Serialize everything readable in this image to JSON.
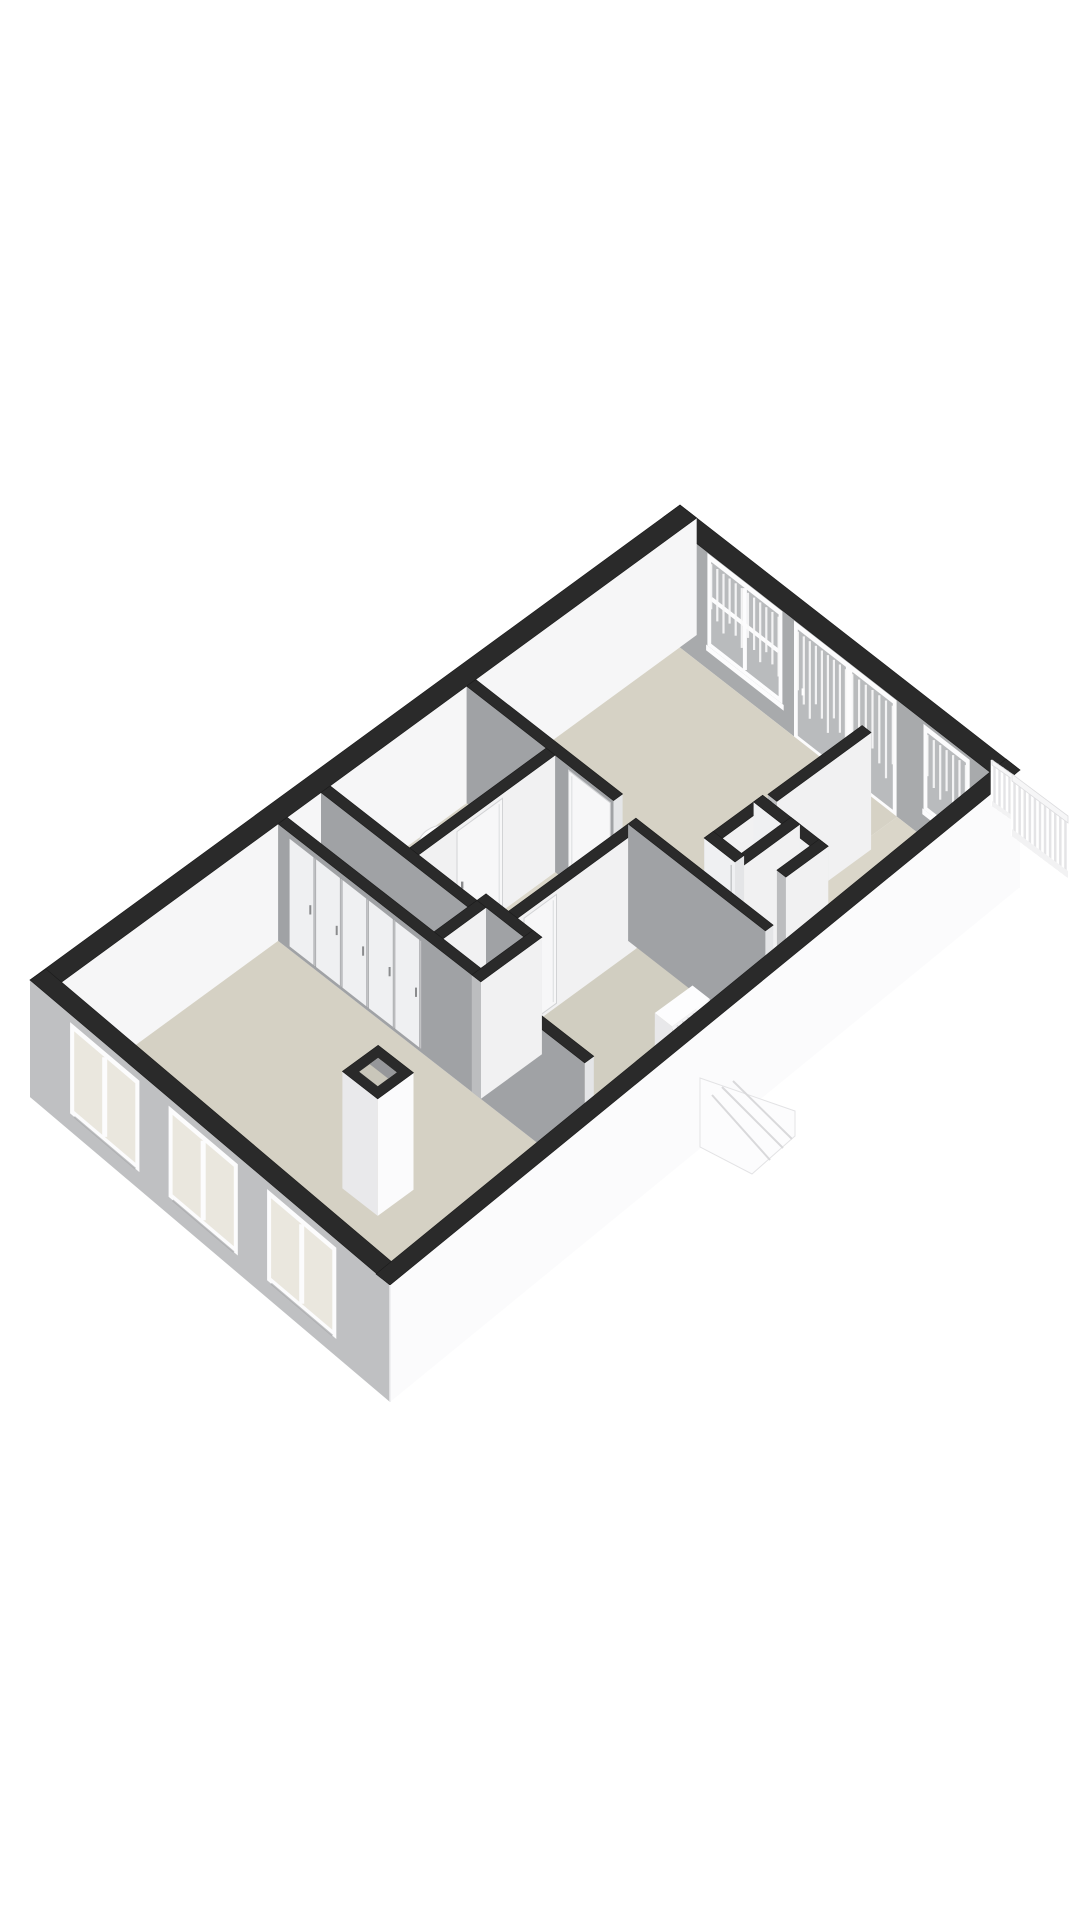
{
  "meta": {
    "type": "3d-floorplan-axonometric",
    "background": "#ffffff",
    "canvas": {
      "width": 1080,
      "height": 1920
    }
  },
  "palette": {
    "cap": "#2a2a2a",
    "capStroke": "#1b1b1b",
    "wallGraySW": "#a0a2a5",
    "wallEndSE": "#e4e5e7",
    "wallWhiteSE": "#f1f1f2",
    "wallEndU": "#bcbdbf",
    "interiorNwFace": "#f6f6f7",
    "interiorNeFace": "#a8aaac",
    "facadeFrontGray": "#bfc0c2",
    "facadeSideWhite": "#fbfbfc",
    "floorBeige": "#d5d1c4",
    "frameWhite": "#fcfcfd",
    "paneGray": "#b9bbbd",
    "paneBeige": "#eae7de",
    "curtain": "#fafafa",
    "panelWhite": "#eff0f2",
    "panelGap": "#c2c3c5",
    "handle": "#8a8b8d",
    "stepLine": "#d9d9db",
    "railBack": "#e4e4e6"
  },
  "projection": {
    "origin": [
      680,
      505
    ],
    "uVec": [
      -65,
      47.5
    ],
    "vVec": [
      64.15,
      50
    ],
    "wallHeightPx": 117,
    "lengthM": 10,
    "widthM": 5.3
  },
  "floors": [
    {
      "name": "floor-back-bedroom",
      "u0": 0.26,
      "u1": 3.4,
      "v0": 0.26,
      "v1": 3.65,
      "fill": "#d6d2c5"
    },
    {
      "name": "floor-balcony-corridor",
      "u0": 0.26,
      "u1": 3.4,
      "v0": 3.65,
      "v1": 5.04,
      "fill": "#dad6c9"
    },
    {
      "name": "floor-wc",
      "u0": 3.54,
      "u1": 5.64,
      "v0": 0.26,
      "v1": 1.5,
      "fill": "#d8d4c7"
    },
    {
      "name": "floor-hall",
      "u0": 3.4,
      "u1": 6.3,
      "v0": 1.64,
      "v1": 5.04,
      "fill": "#dbd7ca"
    },
    {
      "name": "floor-hall-gap",
      "u0": 3.4,
      "u1": 3.54,
      "v0": 0.26,
      "v1": 1.64,
      "fill": "#dbd7ca"
    },
    {
      "name": "floor-closet-strip",
      "u0": 5.78,
      "u1": 6.3,
      "v0": 0.26,
      "v1": 2.55,
      "fill": "#d4d0c3"
    },
    {
      "name": "floor-small-bedroom",
      "u0": 3.66,
      "u1": 6.3,
      "v0": 3.04,
      "v1": 5.04,
      "fill": "#d1cec1"
    },
    {
      "name": "floor-front-room",
      "u0": 6.44,
      "u1": 9.74,
      "v0": 0.26,
      "v1": 5.04,
      "fill": "#d5d1c4"
    }
  ],
  "walls": [
    {
      "name": "wall-exterior-nw",
      "dir": "u",
      "u0": 0,
      "u1": 10,
      "v0": 0,
      "v1": 0.26,
      "faceSE": "#f6f6f7"
    },
    {
      "name": "wall-exterior-ne",
      "dir": "v",
      "u0": 0,
      "u1": 0.26,
      "v0": 0,
      "v1": 5.3,
      "faceSW": "#a8aaac"
    },
    {
      "name": "wall-corridor-divider",
      "dir": "u",
      "u0": 0.8,
      "u1": 2.25,
      "v0": 3.65,
      "v1": 3.79
    },
    {
      "name": "wall-closet-cell-a",
      "dir": "v",
      "u0": 2.3,
      "u1": 2.44,
      "v0": 3.62,
      "v1": 4.64,
      "faceSW": "#eff0f2",
      "panels": {
        "n": 3,
        "v0": 3.7,
        "v1": 4.58
      }
    },
    {
      "name": "wall-closet-cell-b",
      "dir": "u",
      "u0": 2.3,
      "u1": 3.2,
      "v0": 3.62,
      "v1": 3.76
    },
    {
      "name": "wall-closet-cell-c",
      "dir": "v",
      "u0": 3.06,
      "u1": 3.2,
      "v0": 3.62,
      "v1": 4.1,
      "faceSW": "#eff0f2",
      "panels": {
        "n": 1,
        "v0": 3.68,
        "v1": 4.04
      }
    },
    {
      "name": "wall-closet-cell-d",
      "dir": "u",
      "u0": 2.3,
      "u1": 3.2,
      "v0": 4.06,
      "v1": 4.2
    },
    {
      "name": "wall-closet-cell-e",
      "dir": "u",
      "u0": 2.3,
      "u1": 2.95,
      "v0": 4.5,
      "v1": 4.64
    },
    {
      "name": "wall-bedroom-divider",
      "dir": "v",
      "u0": 3.4,
      "u1": 3.54,
      "v0": 0.26,
      "v1": 2.55
    },
    {
      "name": "wall-small-bedroom-ne",
      "dir": "v",
      "u0": 3.54,
      "u1": 3.66,
      "v0": 2.9,
      "v1": 5.04
    },
    {
      "name": "wall-wc-se",
      "dir": "u",
      "u0": 3.54,
      "u1": 5.64,
      "v0": 1.5,
      "v1": 1.64
    },
    {
      "name": "wall-small-bedroom-nw",
      "dir": "u",
      "u0": 3.66,
      "u1": 5.5,
      "v0": 2.9,
      "v1": 3.04
    },
    {
      "name": "wall-wc-sw",
      "dir": "v",
      "u0": 5.64,
      "u1": 5.78,
      "v0": 0.26,
      "v1": 2.55
    },
    {
      "name": "wall-nook-ne",
      "dir": "v",
      "u0": 5.5,
      "u1": 5.64,
      "v0": 2.55,
      "v1": 3.42
    },
    {
      "name": "wall-nook-nw",
      "dir": "u",
      "u0": 5.64,
      "u1": 6.3,
      "v0": 2.55,
      "v1": 2.69
    },
    {
      "name": "wall-nook-se",
      "dir": "u",
      "u0": 5.5,
      "u1": 6.44,
      "v0": 3.28,
      "v1": 3.42
    },
    {
      "name": "wall-front-room-ne",
      "dir": "v",
      "u0": 6.3,
      "u1": 6.44,
      "v0": 0.26,
      "v1": 5.04,
      "panels": {
        "n": 5,
        "v0": 0.42,
        "v1": 2.48
      }
    }
  ],
  "doors": [
    {
      "name": "door-back-bedroom",
      "plane": "u",
      "at": 3.54,
      "a0": 1.85,
      "a1": 2.5,
      "z0": 0.03,
      "z1": 0.96
    },
    {
      "name": "door-wc",
      "plane": "v",
      "at": 1.64,
      "a0": 4.35,
      "a1": 5.05,
      "z0": 0.03,
      "z1": 0.96
    },
    {
      "name": "door-small-bedroom",
      "plane": "v",
      "at": 3.04,
      "a0": 4.9,
      "a1": 5.4,
      "z0": 0.03,
      "z1": 0.96
    }
  ],
  "neOpenings": [
    {
      "name": "window-back-large",
      "type": "window",
      "v0": 0.75,
      "v1": 1.8,
      "z0": 0.24,
      "z1": 0.94,
      "cross": true,
      "curtains": true
    },
    {
      "name": "door-balcony-1",
      "type": "door",
      "v0": 2.1,
      "v1": 2.85,
      "z0": 0.03,
      "z1": 0.94,
      "cross": false,
      "curtains": true
    },
    {
      "name": "door-balcony-2",
      "type": "door",
      "v0": 2.95,
      "v1": 3.58,
      "z0": 0.03,
      "z1": 0.94,
      "cross": false,
      "curtains": true
    },
    {
      "name": "window-corridor",
      "type": "window",
      "v0": 4.12,
      "v1": 4.72,
      "z0": 0.28,
      "z1": 0.92,
      "cross": false,
      "curtains": true
    }
  ],
  "frontWindows": [
    {
      "name": "front-window-1",
      "v0": 0.65,
      "v1": 1.55,
      "z0": 0.2,
      "z1": 0.88
    },
    {
      "name": "front-window-2",
      "v0": 2.1,
      "v1": 3.0,
      "z0": 0.2,
      "z1": 0.88
    },
    {
      "name": "front-window-3",
      "v0": 3.55,
      "v1": 4.45,
      "z0": 0.2,
      "z1": 0.88
    }
  ],
  "facades": {
    "front": {
      "top1": [
        30,
        980
      ],
      "top2": [
        390,
        1285
      ],
      "capInset": [
        16,
        -11
      ]
    },
    "side": {
      "top1": [
        1020,
        770
      ],
      "top2": [
        390,
        1285
      ],
      "capInset": [
        -14,
        -11
      ]
    }
  },
  "chimney": {
    "u0": 7.9,
    "u1": 8.45,
    "v0": 3.3,
    "v1": 3.85,
    "rimInset": 0.13
  },
  "toilet": {
    "cx": 445,
    "cy": 844,
    "rx": 26,
    "ry": 19
  },
  "radiator": {
    "u0": 4.2,
    "u1": 4.78,
    "v0": 4.45,
    "v1": 4.72,
    "zTop": 0.5,
    "fins": 7,
    "valve": {
      "u0": 4.02,
      "u1": 4.2,
      "v0": 4.5,
      "v1": 4.66,
      "zTop": 0.32
    }
  },
  "stairBump": {
    "poly": [
      [
        700,
        1078
      ],
      [
        795,
        1111
      ],
      [
        795,
        1136
      ],
      [
        752,
        1174
      ],
      [
        700,
        1147
      ]
    ],
    "steps": [
      [
        [
          712,
          1095
        ],
        [
          770,
          1160
        ]
      ],
      [
        [
          722,
          1087
        ],
        [
          783,
          1148
        ]
      ],
      [
        [
          733,
          1081
        ],
        [
          792,
          1139
        ]
      ]
    ]
  },
  "railing": {
    "main": {
      "x": 1012,
      "y": 774,
      "dx": 56,
      "dy": 42,
      "drop": 62,
      "band": 7,
      "n": 11
    },
    "ret": {
      "x": 992,
      "y": 760,
      "dx": 20,
      "dy": 14,
      "drop": 46,
      "band": 5,
      "n": 4
    }
  }
}
